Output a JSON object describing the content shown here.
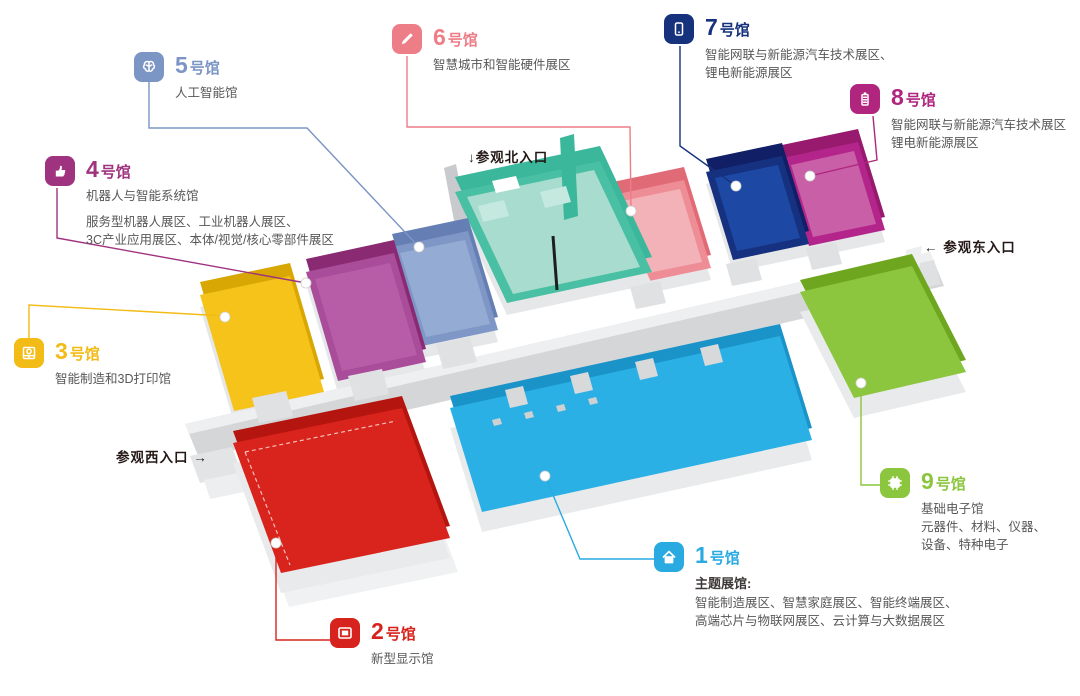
{
  "entrances": {
    "north_arrow": "↓",
    "north_label": "参观北入口",
    "east_arrow": "←",
    "east_label": "参观东入口",
    "west_label": "参观西入口",
    "west_arrow": "→"
  },
  "north_hall": {
    "wall": "#3bb79b",
    "floor": "#49bfa3",
    "inner": "#a7dcce",
    "booth": "#c6e9df"
  },
  "halls": [
    {
      "number": "1",
      "suffix": "号馆",
      "color": "#29abe2",
      "floor": "#2bb0e5",
      "wall": "#1a93c8",
      "subtitle": "主题展馆:",
      "details": [
        "智能制造展区、智慧家庭展区、智能终端展区、",
        "高端芯片与物联网展区、云计算与大数据展区"
      ],
      "icon": "home-icon"
    },
    {
      "number": "2",
      "suffix": "号馆",
      "color": "#d7231d",
      "floor": "#d8241c",
      "wall": "#b5150f",
      "details": [
        "新型显示馆"
      ],
      "icon": "display-icon"
    },
    {
      "number": "3",
      "suffix": "号馆",
      "color": "#f2bb16",
      "floor": "#f5c31a",
      "wall": "#d8a703",
      "details": [
        "智能制造和3D打印馆"
      ],
      "icon": "printer-icon"
    },
    {
      "number": "4",
      "suffix": "号馆",
      "color": "#a0337f",
      "floor": "#a94c99",
      "wall": "#8a2a72",
      "inner": "#b75ca6",
      "subtitle": "机器人与智能系统馆",
      "details": [
        "服务型机器人展区、工业机器人展区、",
        "3C产业应用展区、本体/视觉/核心零部件展区"
      ],
      "icon": "hand-icon"
    },
    {
      "number": "5",
      "suffix": "号馆",
      "color": "#7b95c4",
      "floor": "#7e97c6",
      "wall": "#657fb4",
      "inner": "#94abd3",
      "details": [
        "人工智能馆"
      ],
      "icon": "brain-icon"
    },
    {
      "number": "6",
      "suffix": "号馆",
      "color": "#ed7d87",
      "floor": "#ee8d95",
      "wall": "#e06a76",
      "inner": "#f3b2b7",
      "details": [
        "智慧城市和智能硬件展区"
      ],
      "icon": "pen-icon"
    },
    {
      "number": "7",
      "suffix": "号馆",
      "color": "#16327c",
      "floor": "#16317f",
      "wall": "#101f66",
      "inner": "#1d49a5",
      "details": [
        "智能网联与新能源汽车技术展区、",
        "锂电新能源展区"
      ],
      "icon": "phone-icon"
    },
    {
      "number": "8",
      "suffix": "号馆",
      "color": "#b0267f",
      "floor": "#b3258b",
      "wall": "#971a6f",
      "inner": "#c85fa7",
      "details": [
        "智能网联与新能源汽车技术展区",
        "锂电新能源展区"
      ],
      "icon": "battery-icon"
    },
    {
      "number": "9",
      "suffix": "号馆",
      "color": "#8cc63f",
      "floor": "#8cc63e",
      "wall": "#6fa61f",
      "details": [
        "基础电子馆",
        "元器件、材料、仪器、",
        "设备、特种电子"
      ],
      "icon": "chip-icon"
    }
  ]
}
